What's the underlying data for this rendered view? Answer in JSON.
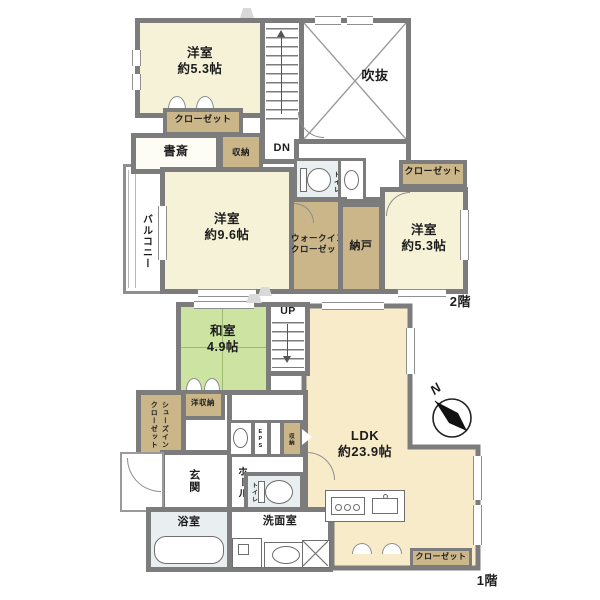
{
  "palette": {
    "wall": "#7c7c7c",
    "western_room_fill": "#f5f2d8",
    "closet_fill": "#cbb68a",
    "tatami_fill": "#cde3a2",
    "ldk_fill": "#f7ebca",
    "wet_area_fill": "#e9eef0"
  },
  "floor2": {
    "label": "2階",
    "western_room_a": "洋室\n約5.3帖",
    "void": "吹抜",
    "stairs_down": "DN",
    "closet_a": "クローゼット",
    "study": "書斎",
    "storage": "収納",
    "balcony": "バルコニー",
    "western_room_b": "洋室\n約9.6帖",
    "toilet": "トイレ",
    "walk_in_closet": "ウォークイン\nクローゼット",
    "storage_room": "納戸",
    "closet_b": "クローゼット",
    "western_room_c": "洋室\n約5.3帖"
  },
  "floor1": {
    "label": "1階",
    "japanese_room": "和室\n4.9帖",
    "stairs_up": "UP",
    "ldk": "LDK\n約23.9帖",
    "western_storage": "洋収納",
    "shoes_in_closet": "シューズイン\nクローゼット",
    "entrance": "玄関",
    "hall": "ホール",
    "eps": "EPS",
    "storage": "収納",
    "toilet": "トイレ",
    "bathroom": "浴室",
    "washroom": "洗面室",
    "closet": "クローゼット",
    "compass_north": "N"
  }
}
